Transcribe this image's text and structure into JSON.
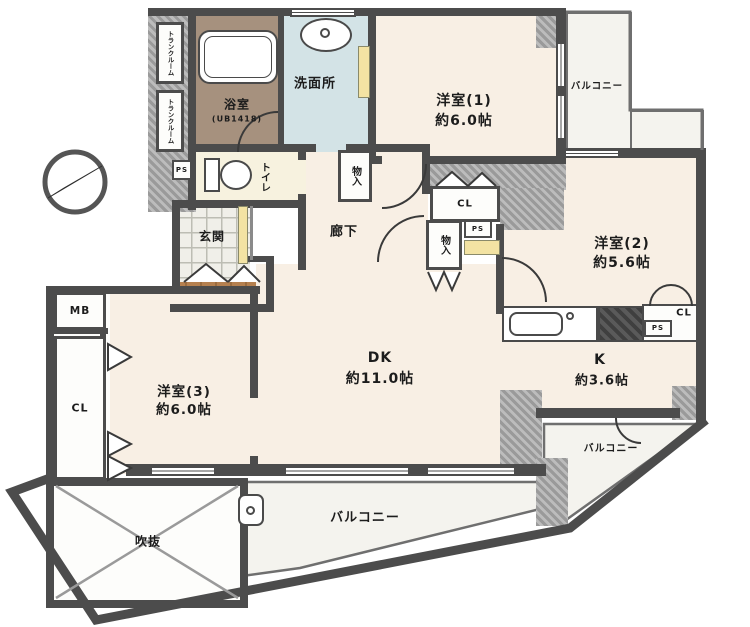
{
  "plan": {
    "type": "apartment-floor-plan",
    "rooms": {
      "western1": {
        "label": "洋室(1)",
        "area": "約6.0帖"
      },
      "western2": {
        "label": "洋室(2)",
        "area": "約5.6帖"
      },
      "western3": {
        "label": "洋室(3)",
        "area": "約6.0帖"
      },
      "dining_kitchen": {
        "label": "DK",
        "area": "約11.0帖"
      },
      "kitchen": {
        "label": "K",
        "area": "約3.6帖"
      },
      "bathroom": {
        "label": "浴室",
        "note": "(UB1418)"
      },
      "washroom": {
        "label": "洗面所"
      },
      "toilet": {
        "label": "トイレ"
      },
      "entrance": {
        "label": "玄関"
      },
      "hallway": {
        "label": "廊下"
      },
      "void": {
        "label": "吹抜"
      },
      "balcony_top_right": {
        "label": "バルコニー"
      },
      "balcony_right": {
        "label": "バルコニー"
      },
      "balcony_bottom": {
        "label": "バルコニー"
      }
    },
    "storage": {
      "closet_western3": "CL",
      "closet_hall": "CL",
      "closet_kitchen": "CL",
      "meter_box": "MB",
      "pipe_space_toilet": "PS",
      "pipe_space_hall": "PS",
      "pipe_space_kitchen": "PS",
      "storage_hall_upper": "物入",
      "storage_hall_lower": "物入",
      "trunk_room_1": "トランクルーム",
      "trunk_room_2": "トランクルーム"
    },
    "colors": {
      "wall": "#4c4c4c",
      "room_floor": "#f8efe4",
      "bath_floor": "#a6917e",
      "washroom_floor": "#d3e3e6",
      "toilet_floor": "#f7f2df",
      "wood_porch": "#b5804f",
      "balcony": "#f4f3ee",
      "accent_yellow": "#f3e3a3"
    }
  }
}
